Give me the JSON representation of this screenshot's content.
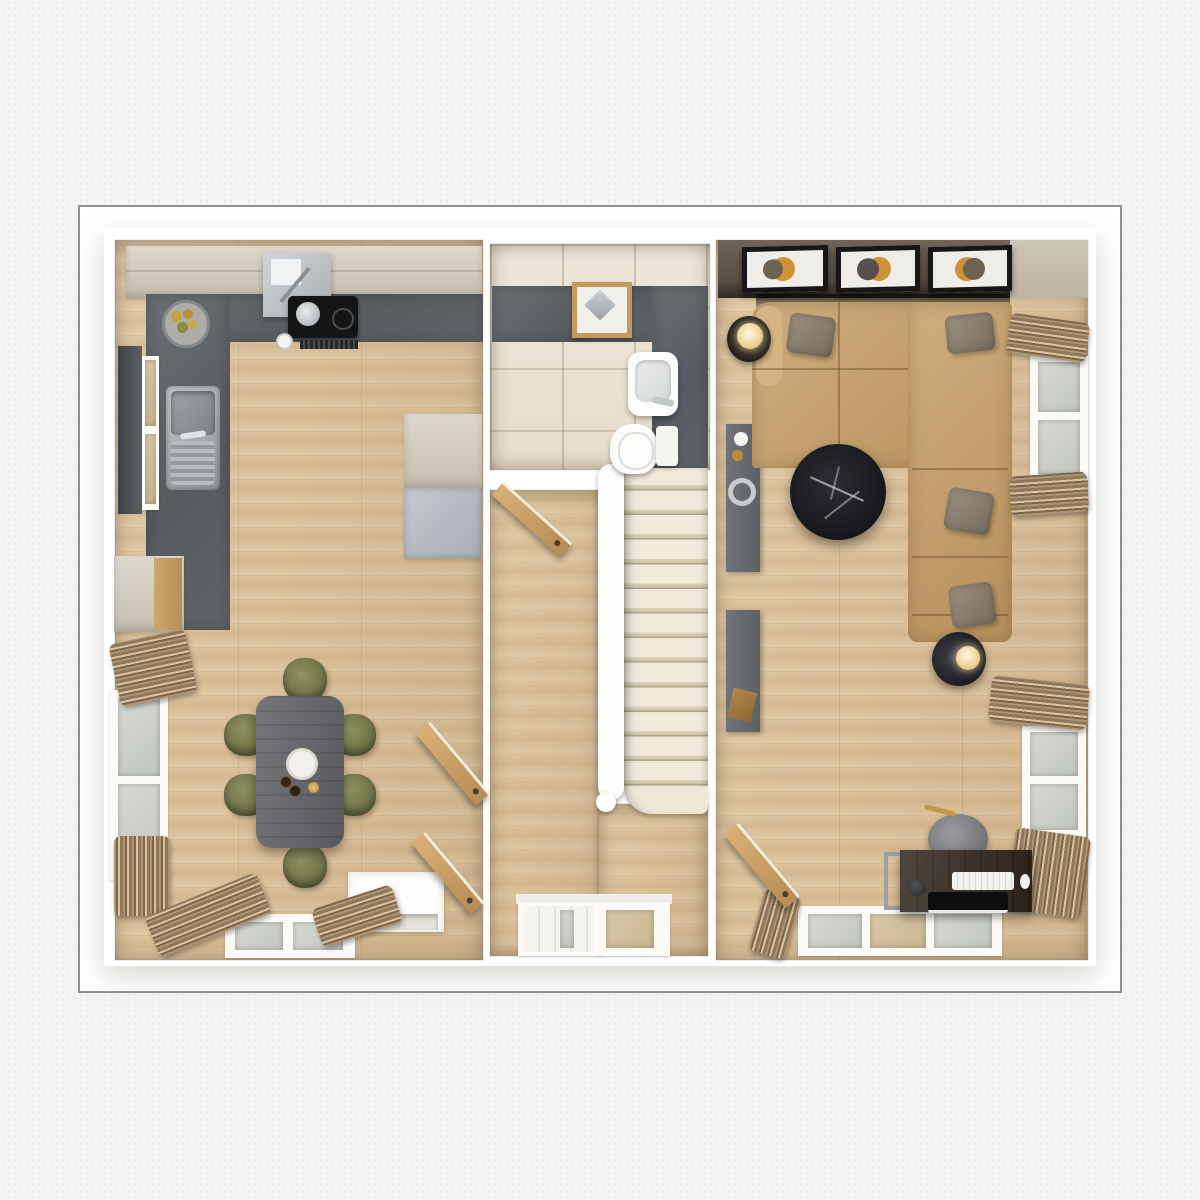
{
  "scene": {
    "description": "3D top-down architectural floor plan render, ground floor",
    "rooms": [
      {
        "id": "kitchen-dining",
        "label": "Kitchen / Dining Room",
        "furniture": [
          "upper cabinets",
          "cooker hood",
          "induction hob",
          "saucepan",
          "extractor vent",
          "L-shaped slate worktop",
          "stainless sink",
          "fruit bowl",
          "coffee cup",
          "tall cabinet",
          "fridge freezer",
          "sideboard",
          "dining table",
          "6 olive dining chairs",
          "cake stand",
          "2 bottles",
          "candle",
          "window with dark blind",
          "tall side windows",
          "4 curtain bundles",
          "2 open doors",
          "fireplace recess",
          "bottom window"
        ]
      },
      {
        "id": "bathroom",
        "label": "Bathroom",
        "furniture": [
          "slate feature wall",
          "vanity tray mirror",
          "washbasin with chrome tap",
          "toilet with cistern"
        ]
      },
      {
        "id": "hallway",
        "label": "Hallway",
        "furniture": [
          "carpeted staircase of 13 treads",
          "white banister",
          "open bathroom door",
          "front door with glazed panel",
          "glazed sidelight"
        ]
      },
      {
        "id": "living-room",
        "label": "Living Room",
        "furniture": [
          "dark feature wall",
          "3 framed artworks",
          "corner sofa with chaise",
          "5 throw pillows",
          "floor lamp",
          "round black marble coffee table",
          "tray side lamp",
          "media console with vase and tray",
          "storage console",
          "2 side windows",
          "bottom window",
          "6 curtain bundles",
          "open door",
          "desk on metal frame",
          "keyboard",
          "mouse",
          "laptop",
          "desk plant",
          "grey pouf chair",
          "gold pencil"
        ]
      }
    ]
  },
  "palette": {
    "page": "#f4f4f3",
    "border": "#8f9093",
    "wall": "#ffffff",
    "wood": "#d7bc94",
    "tile": "#e9e2d4",
    "slate": "#5d6266",
    "cabinet": "#d3ccc0",
    "fridge": "#b6bdc3",
    "sofa": "#c49f6b",
    "pillow": "#8b8072",
    "chair": "#7b7e51",
    "feature": "#5e5549",
    "marble": "#1c1e22",
    "art": "#d09036",
    "doorwood": "#c9a267",
    "glass": "#ced1c9",
    "tread": "#f0e8d8",
    "curtain": "#8f775a",
    "table": "#65666b",
    "desk": "#382c21"
  }
}
